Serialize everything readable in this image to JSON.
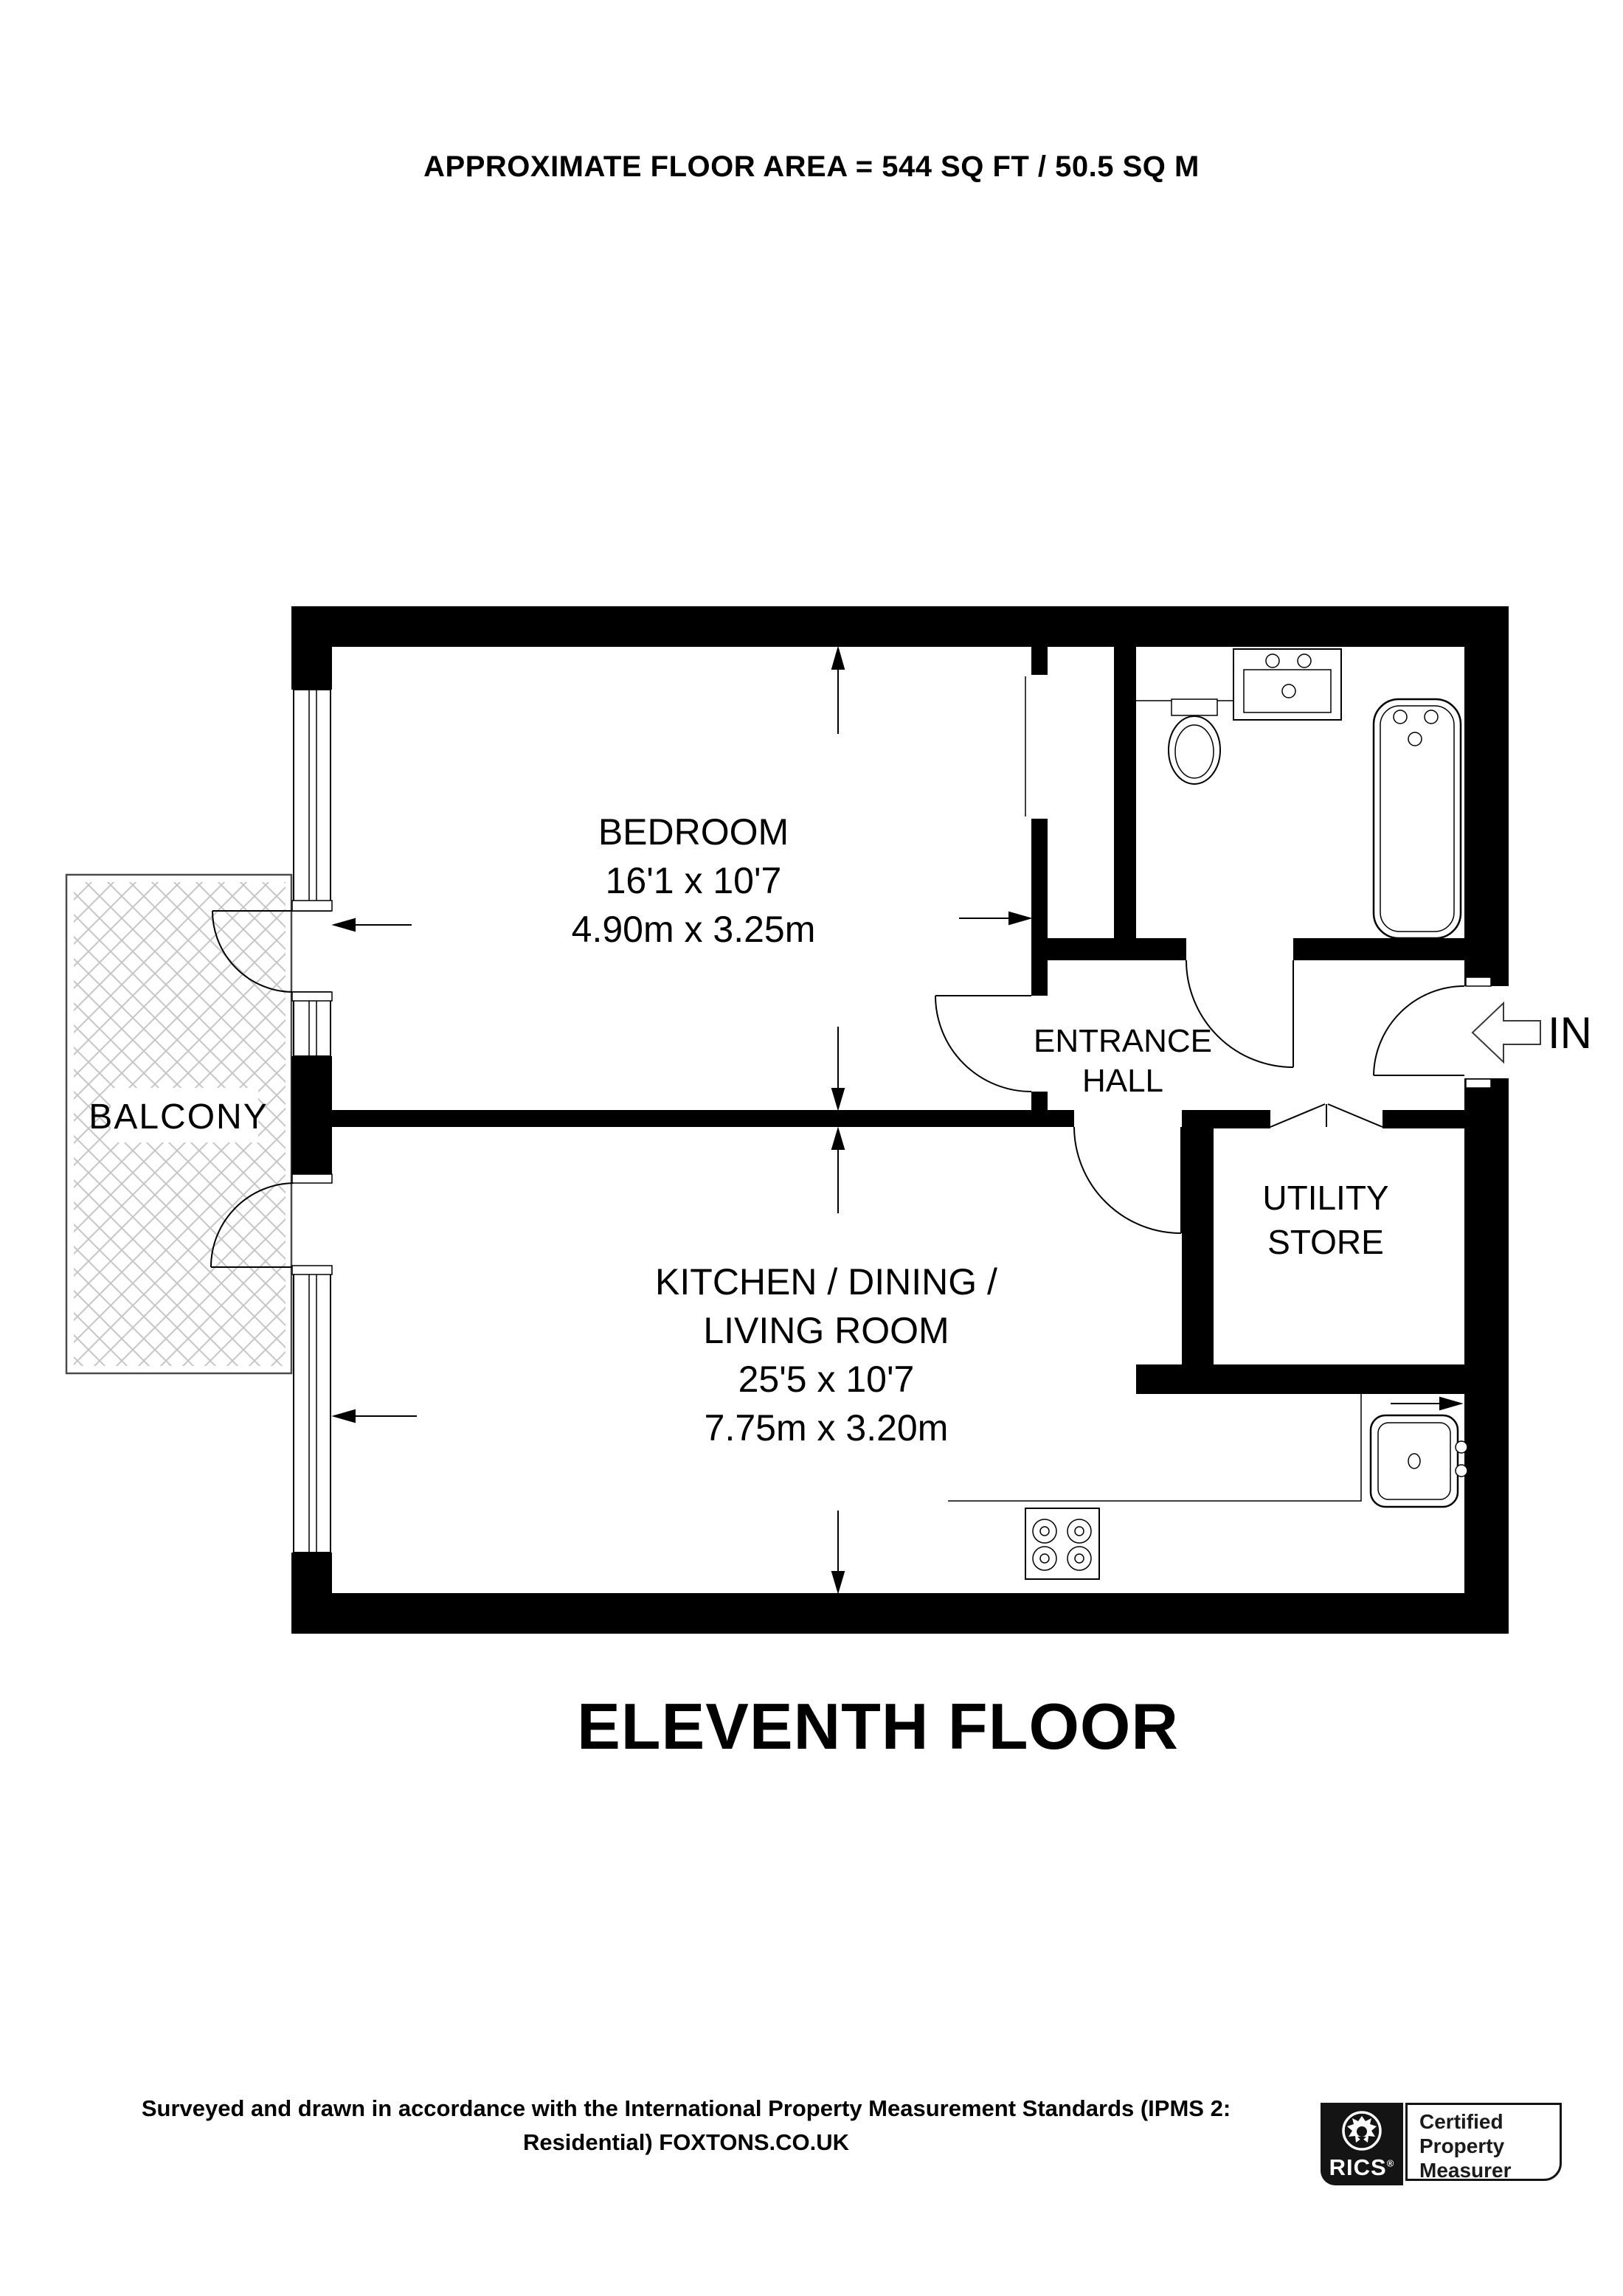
{
  "title": "APPROXIMATE FLOOR AREA = 544 SQ FT / 50.5 SQ M",
  "plan": {
    "floor_label": "ELEVENTH FLOOR",
    "balcony": {
      "label": "BALCONY"
    },
    "bedroom": {
      "label": "BEDROOM",
      "imperial": "16'1 x 10'7",
      "metric": "4.90m x 3.25m"
    },
    "kitchen": {
      "label_line1": "KITCHEN / DINING /",
      "label_line2": "LIVING ROOM",
      "imperial": "25'5 x 10'7",
      "metric": "7.75m x 3.20m"
    },
    "entrance_hall": {
      "label_line1": "ENTRANCE",
      "label_line2": "HALL"
    },
    "utility_store": {
      "label_line1": "UTILITY",
      "label_line2": "STORE"
    },
    "entrance": {
      "label": "IN"
    }
  },
  "footer": {
    "line1": "Surveyed and drawn in accordance with the International Property Measurement Standards (IPMS 2:",
    "line2": "Residential) FOXTONS.CO.UK"
  },
  "badge": {
    "brand": "RICS",
    "registered": "®",
    "line1": "Certified",
    "line2": "Property",
    "line3": "Measurer"
  },
  "colors": {
    "wall": "#000000",
    "hatch": "#c6c6c6",
    "background": "#ffffff"
  }
}
